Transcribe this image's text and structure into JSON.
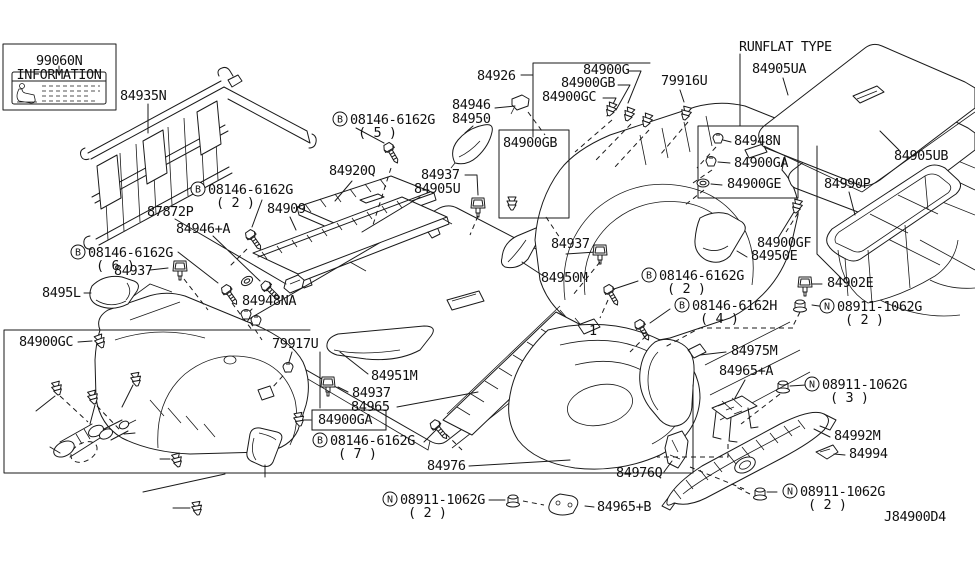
{
  "diagram": {
    "code": "J84900D4",
    "section_note": "RUNFLAT TYPE",
    "info_card": {
      "part_no": "99060N",
      "title": "INFORMATION"
    },
    "labels": [
      {
        "text": "99060N",
        "x": 36,
        "y": 65
      },
      {
        "text": "84935N",
        "x": 120,
        "y": 100
      },
      {
        "text": "84926",
        "x": 477,
        "y": 80
      },
      {
        "text": "84900G",
        "x": 583,
        "y": 74
      },
      {
        "text": "84900GB",
        "x": 561,
        "y": 87
      },
      {
        "text": "84900GC",
        "x": 542,
        "y": 101
      },
      {
        "text": "84946",
        "x": 452,
        "y": 109
      },
      {
        "text": "84950",
        "x": 452,
        "y": 123
      },
      {
        "prefix": "B",
        "text": "08146-6162G",
        "qty": "( 5 )",
        "x": 350,
        "y": 124
      },
      {
        "text": "84920Q",
        "x": 329,
        "y": 175
      },
      {
        "text": "84937",
        "x": 421,
        "y": 179
      },
      {
        "text": "84905U",
        "x": 414,
        "y": 193
      },
      {
        "text": "84900GB",
        "x": 503,
        "y": 147
      },
      {
        "text": "RUNFLAT TYPE",
        "x": 739,
        "y": 51
      },
      {
        "text": "84905UA",
        "x": 752,
        "y": 73
      },
      {
        "text": "79916U",
        "x": 661,
        "y": 85
      },
      {
        "text": "84948N",
        "x": 734,
        "y": 145
      },
      {
        "text": "84900GA",
        "x": 734,
        "y": 167
      },
      {
        "text": "84900GE",
        "x": 727,
        "y": 188
      },
      {
        "text": "84905UB",
        "x": 894,
        "y": 160
      },
      {
        "text": "84990P",
        "x": 824,
        "y": 188
      },
      {
        "prefix": "B",
        "text": "08146-6162G",
        "qty": "( 2 )",
        "x": 208,
        "y": 194
      },
      {
        "text": "87872P",
        "x": 147,
        "y": 216
      },
      {
        "text": "84909",
        "x": 267,
        "y": 213
      },
      {
        "text": "84946+A",
        "x": 176,
        "y": 233
      },
      {
        "prefix": "B",
        "text": "08146-6162G",
        "qty": "( 6 )",
        "x": 88,
        "y": 257
      },
      {
        "text": "84937",
        "x": 114,
        "y": 275
      },
      {
        "text": "8495L",
        "x": 42,
        "y": 297
      },
      {
        "text": "84948NA",
        "x": 242,
        "y": 305
      },
      {
        "text": "84900GC",
        "x": 19,
        "y": 346
      },
      {
        "text": "79917U",
        "x": 272,
        "y": 348
      },
      {
        "text": "84937",
        "x": 551,
        "y": 248
      },
      {
        "text": "84950M",
        "x": 541,
        "y": 282
      },
      {
        "prefix": "B",
        "text": "08146-6162G",
        "qty": "( 2 )",
        "x": 659,
        "y": 280
      },
      {
        "text": "84900GF",
        "x": 757,
        "y": 247
      },
      {
        "text": "84950E",
        "x": 751,
        "y": 260
      },
      {
        "text": "84902E",
        "x": 827,
        "y": 287
      },
      {
        "prefix": "B",
        "text": "08146-6162H",
        "qty": "( 4 )",
        "x": 692,
        "y": 310
      },
      {
        "prefix": "N",
        "text": "08911-1062G",
        "qty": "( 2 )",
        "x": 837,
        "y": 311
      },
      {
        "text": "84975M",
        "x": 731,
        "y": 355
      },
      {
        "text": "84965+A",
        "x": 719,
        "y": 375
      },
      {
        "text": "84951M",
        "x": 371,
        "y": 380
      },
      {
        "text": "84937",
        "x": 352,
        "y": 397
      },
      {
        "text": "84965",
        "x": 351,
        "y": 411
      },
      {
        "text": "84900GA",
        "x": 318,
        "y": 424,
        "boxed": true
      },
      {
        "prefix": "B",
        "text": "08146-6162G",
        "qty": "( 7 )",
        "x": 330,
        "y": 445
      },
      {
        "text": "84976",
        "x": 427,
        "y": 470
      },
      {
        "prefix": "N",
        "text": "08911-1062G",
        "qty": "( 3 )",
        "x": 822,
        "y": 389
      },
      {
        "text": "84992M",
        "x": 834,
        "y": 440
      },
      {
        "text": "84994",
        "x": 849,
        "y": 458
      },
      {
        "text": "84976Q",
        "x": 616,
        "y": 477
      },
      {
        "prefix": "N",
        "text": "08911-1062G",
        "qty": "( 2 )",
        "x": 400,
        "y": 504
      },
      {
        "text": "84965+B",
        "x": 597,
        "y": 511
      },
      {
        "prefix": "N",
        "text": "08911-1062G",
        "qty": "( 2 )",
        "x": 800,
        "y": 496
      },
      {
        "text": "J84900D4",
        "x": 884,
        "y": 521,
        "size": 16
      },
      {
        "text": "1",
        "x": 589,
        "y": 335,
        "size": 11
      }
    ]
  }
}
